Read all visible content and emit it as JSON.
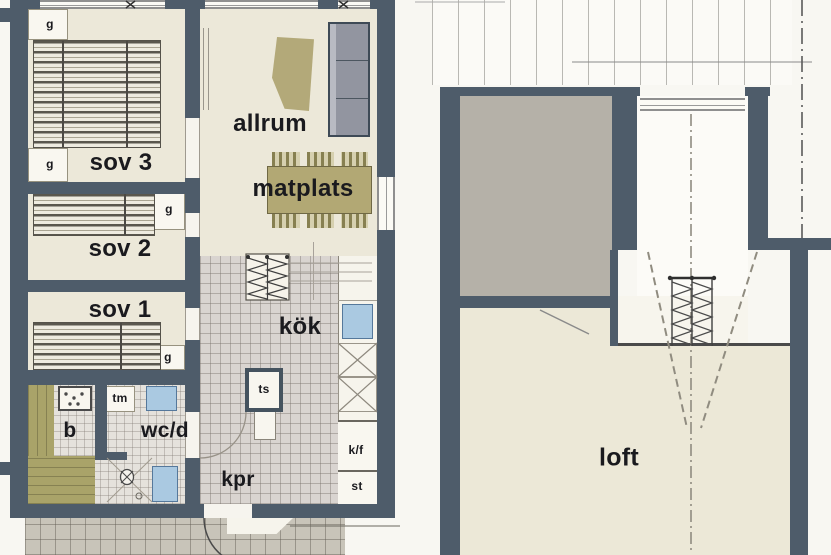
{
  "document": {
    "type": "floor-plan-drawing",
    "language": "Swedish",
    "plans": [
      {
        "name": "ground-floor",
        "rooms": [
          "sov 3",
          "sov 2",
          "sov 1",
          "allrum",
          "matplats",
          "kök",
          "b",
          "wc/d",
          "kpr"
        ],
        "fixtures": [
          "g",
          "tm",
          "ts",
          "k/f",
          "st"
        ]
      },
      {
        "name": "loft-floor",
        "rooms": [
          "loft"
        ]
      }
    ]
  },
  "ground_floor": {
    "sov3": "sov 3",
    "sov2": "sov 2",
    "sov1": "sov 1",
    "allrum": "allrum",
    "matplats": "matplats",
    "kok": "kök",
    "bastu": "b",
    "wcd": "wc/d",
    "kpr": "kpr",
    "closet": "g",
    "washer": "tm",
    "drying_cabinet": "ts",
    "fridge_freezer": "k/f",
    "storage": "st"
  },
  "loft_floor": {
    "loft": "loft"
  },
  "colors": {
    "wall": "#4e5c6a",
    "floor_cream": "#ece8d9",
    "kitchen_tile": "#d9d4d0",
    "bath_tile": "#e5e2dc",
    "terrace": "#c8c4b9",
    "roof_gray": "#b5b1a8",
    "furniture_khaki": "#b2a874",
    "sofa_gray": "#9295a0",
    "fixture_blue": "#aac9e1"
  }
}
